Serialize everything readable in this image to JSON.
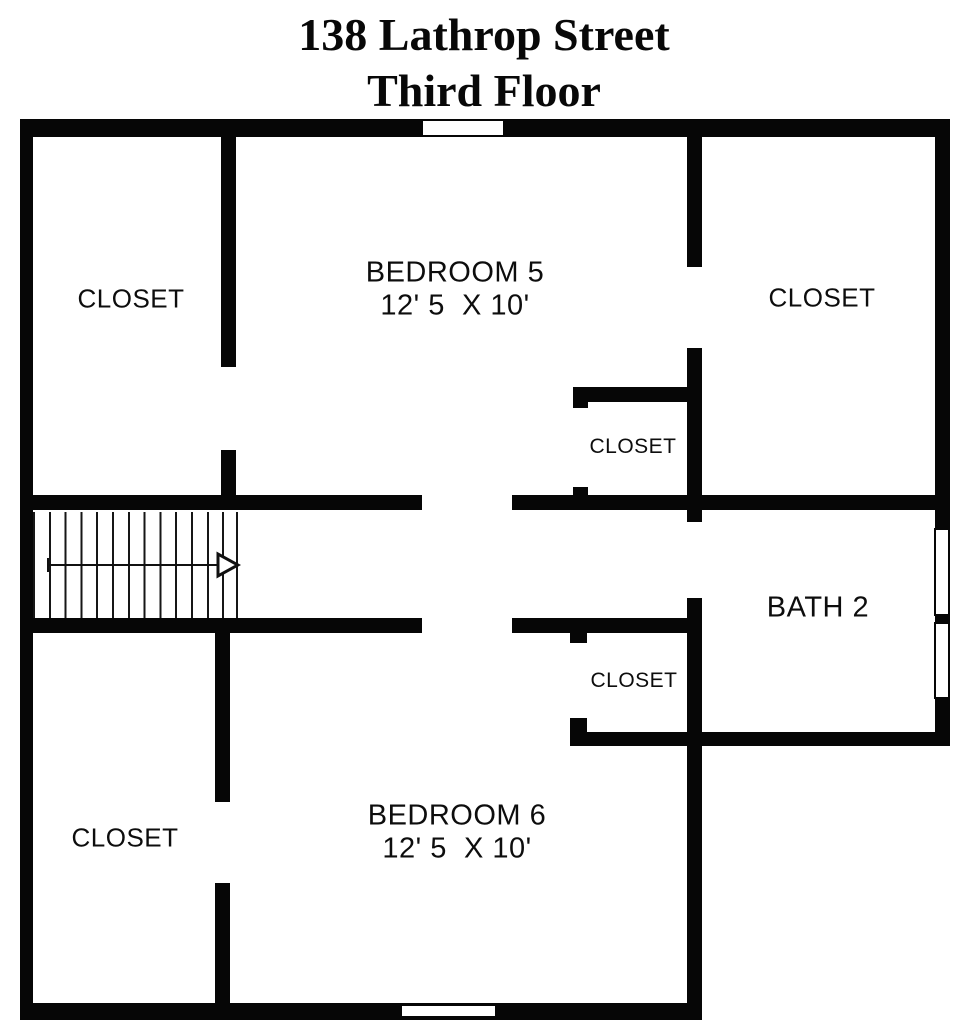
{
  "title": {
    "line1": "138 Lathrop Street",
    "line2": "Third Floor"
  },
  "rooms": {
    "bedroom5": {
      "name": "BEDROOM 5",
      "dims": "12' 5  X 10'"
    },
    "bedroom6": {
      "name": "BEDROOM 6",
      "dims": "12' 5  X 10'"
    },
    "bath2": {
      "name": "BATH 2"
    },
    "closet_upper_left": {
      "label": "CLOSET"
    },
    "closet_upper_right": {
      "label": "CLOSET"
    },
    "closet_mid_upper": {
      "label": "CLOSET"
    },
    "closet_mid_lower": {
      "label": "CLOSET"
    },
    "closet_lower_left": {
      "label": "CLOSET"
    }
  },
  "colors": {
    "wall": "#060606",
    "background": "#ffffff",
    "text": "#0d0d0d"
  }
}
